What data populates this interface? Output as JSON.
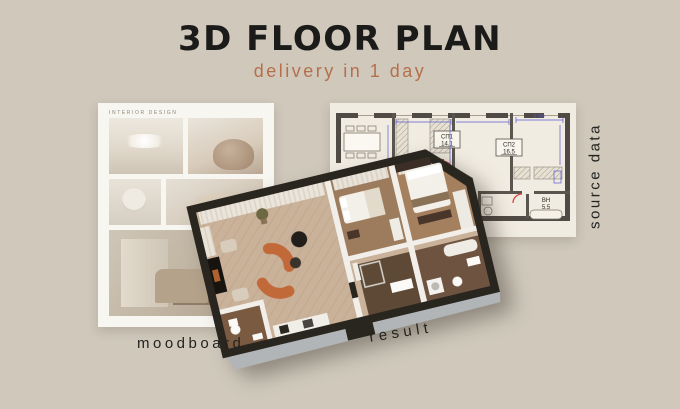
{
  "header": {
    "title": "3D FLOOR PLAN",
    "subtitle": "delivery in 1 day"
  },
  "captions": {
    "moodboard": "moodboard",
    "result": "result",
    "source_data": "source data"
  },
  "moodboard_card": {
    "header_text": "interior design",
    "photos": [
      "pendant-light",
      "armchair",
      "vase-sculpture",
      "lounge-chair",
      "desk-workspace"
    ]
  },
  "technical_plan": {
    "dimension_label": "3 700",
    "rooms": [
      {
        "label": "СП1",
        "area": "14.1"
      },
      {
        "label": "СП2",
        "area": "16.5"
      },
      {
        "label": "ВН",
        "area": "5.5"
      }
    ]
  },
  "colors": {
    "background": "#CFC8BB",
    "title": "#1B1B19",
    "accent_terracotta": "#B56F4B",
    "plan_wall_dark": "#29251F",
    "plan_floor_light": "#C9B299",
    "plan_floor_wood": "#9D7C5D",
    "sofa_orange": "#C2693A",
    "drawing_door_red": "#DD4238",
    "drawing_dimension_blue": "#5B5BD6",
    "paper_cream": "#F1ECE1",
    "card_white": "#F8F6F1"
  }
}
